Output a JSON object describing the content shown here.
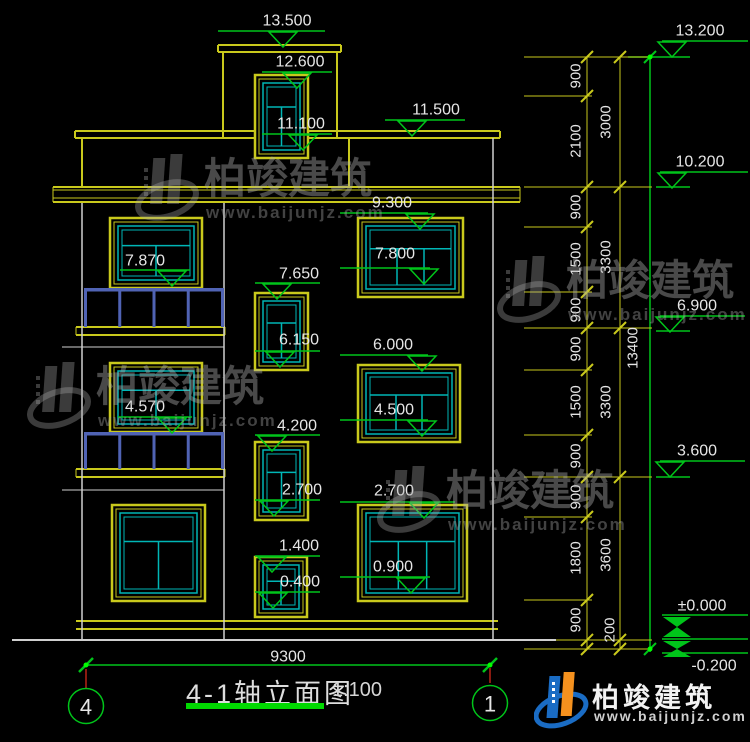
{
  "title": {
    "text": "4-1轴立面图",
    "scale": "1:100"
  },
  "brand": {
    "name": "柏竣建筑",
    "url": "www.baijunjz.com"
  },
  "axes": [
    {
      "label": "4",
      "cx": 86,
      "cy": 706
    },
    {
      "label": "1",
      "cx": 490,
      "cy": 703
    }
  ],
  "colors": {
    "yellow": "#c9c91c",
    "white": "#cfcfcf",
    "green": "#00c41a",
    "cyan": "#00b6b6",
    "blue": "#5063b4",
    "red": "#8a1a10",
    "text": "#e6e6e6",
    "dot": "#00ff00"
  },
  "drawing": {
    "lines": [
      {
        "p": [
          218,
          45,
          341,
          45
        ],
        "c": "yellow",
        "w": 2
      },
      {
        "p": [
          218,
          52,
          341,
          52
        ],
        "c": "yellow",
        "w": 2
      },
      {
        "p": [
          218,
          45,
          218,
          52
        ],
        "c": "yellow",
        "w": 2
      },
      {
        "p": [
          341,
          45,
          341,
          52
        ],
        "c": "yellow",
        "w": 2
      },
      {
        "p": [
          223,
          52,
          223,
          138
        ],
        "c": "yellow",
        "w": 2
      },
      {
        "p": [
          337,
          52,
          337,
          138
        ],
        "c": "yellow",
        "w": 2
      },
      {
        "p": [
          75,
          131,
          500,
          131
        ],
        "c": "yellow",
        "w": 2
      },
      {
        "p": [
          75,
          138,
          500,
          138
        ],
        "c": "yellow",
        "w": 2
      },
      {
        "p": [
          75,
          131,
          75,
          138
        ],
        "c": "yellow",
        "w": 2
      },
      {
        "p": [
          500,
          131,
          500,
          138
        ],
        "c": "yellow",
        "w": 2
      },
      {
        "p": [
          82,
          138,
          82,
          187
        ],
        "c": "yellow",
        "w": 2
      },
      {
        "p": [
          349,
          138,
          349,
          187
        ],
        "c": "yellow",
        "w": 2
      },
      {
        "p": [
          53,
          187,
          520,
          187
        ],
        "c": "yellow",
        "w": 2
      },
      {
        "p": [
          53,
          190,
          520,
          190
        ],
        "c": "yellow",
        "w": 1
      },
      {
        "p": [
          53,
          198,
          520,
          198
        ],
        "c": "yellow",
        "w": 1
      },
      {
        "p": [
          53,
          202,
          520,
          202
        ],
        "c": "yellow",
        "w": 2
      },
      {
        "p": [
          53,
          187,
          53,
          202
        ],
        "c": "yellow",
        "w": 1
      },
      {
        "p": [
          520,
          187,
          520,
          202
        ],
        "c": "yellow",
        "w": 1
      },
      {
        "p": [
          76,
          621,
          498,
          621
        ],
        "c": "yellow",
        "w": 2
      },
      {
        "p": [
          76,
          629,
          498,
          629
        ],
        "c": "yellow",
        "w": 2
      },
      {
        "p": [
          76,
          327,
          225,
          327
        ],
        "c": "yellow",
        "w": 2
      },
      {
        "p": [
          76,
          335,
          225,
          335
        ],
        "c": "yellow",
        "w": 2
      },
      {
        "p": [
          76,
          327,
          76,
          335
        ],
        "c": "yellow",
        "w": 1
      },
      {
        "p": [
          225,
          327,
          225,
          335
        ],
        "c": "yellow",
        "w": 1
      },
      {
        "p": [
          76,
          469,
          225,
          469
        ],
        "c": "yellow",
        "w": 2
      },
      {
        "p": [
          76,
          477,
          225,
          477
        ],
        "c": "yellow",
        "w": 2
      },
      {
        "p": [
          76,
          469,
          76,
          477
        ],
        "c": "yellow",
        "w": 1
      },
      {
        "p": [
          225,
          469,
          225,
          477
        ],
        "c": "yellow",
        "w": 1
      },
      {
        "p": [
          493,
          138,
          493,
          640
        ],
        "c": "white",
        "w": 1.5
      },
      {
        "p": [
          82,
          203,
          82,
          640
        ],
        "c": "white",
        "w": 1.5
      },
      {
        "p": [
          224,
          203,
          224,
          640
        ],
        "c": "white",
        "w": 1.5
      },
      {
        "p": [
          62,
          347,
          224,
          347
        ],
        "c": "white",
        "w": 1
      },
      {
        "p": [
          62,
          490,
          224,
          490
        ],
        "c": "white",
        "w": 1
      },
      {
        "p": [
          12,
          640,
          556,
          640
        ],
        "c": "white",
        "w": 2
      },
      {
        "p": [
          86,
          665,
          490,
          665
        ],
        "c": "green",
        "w": 1.5
      },
      {
        "p": [
          650,
          57,
          650,
          652
        ],
        "c": "green",
        "w": 1.5
      },
      {
        "p": [
          628,
          57,
          690,
          57
        ],
        "c": "green",
        "w": 1.5
      },
      {
        "p": [
          656,
          187,
          690,
          187
        ],
        "c": "green",
        "w": 1.5
      },
      {
        "p": [
          656,
          331,
          690,
          331
        ],
        "c": "green",
        "w": 1.5
      },
      {
        "p": [
          656,
          477,
          690,
          477
        ],
        "c": "green",
        "w": 1.5
      },
      {
        "p": [
          662,
          615,
          748,
          615
        ],
        "c": "green",
        "w": 1.5
      },
      {
        "p": [
          662,
          639,
          748,
          639
        ],
        "c": "green",
        "w": 1.5
      },
      {
        "p": [
          662,
          653,
          748,
          653
        ],
        "c": "green",
        "w": 1.5
      },
      {
        "p": [
          587,
          57,
          587,
          649
        ],
        "c": "yellow",
        "w": 1
      },
      {
        "p": [
          620,
          57,
          620,
          649
        ],
        "c": "yellow",
        "w": 1
      },
      {
        "p": [
          524,
          96,
          592,
          96
        ],
        "c": "yellow",
        "w": 1
      },
      {
        "p": [
          524,
          227,
          592,
          227
        ],
        "c": "yellow",
        "w": 1
      },
      {
        "p": [
          524,
          292,
          592,
          292
        ],
        "c": "yellow",
        "w": 1
      },
      {
        "p": [
          524,
          370,
          592,
          370
        ],
        "c": "yellow",
        "w": 1
      },
      {
        "p": [
          524,
          435,
          592,
          435
        ],
        "c": "yellow",
        "w": 1
      },
      {
        "p": [
          524,
          517,
          592,
          517
        ],
        "c": "yellow",
        "w": 1
      },
      {
        "p": [
          524,
          600,
          592,
          600
        ],
        "c": "yellow",
        "w": 1
      },
      {
        "p": [
          524,
          57,
          652,
          57
        ],
        "c": "yellow",
        "w": 1
      },
      {
        "p": [
          524,
          187,
          652,
          187
        ],
        "c": "yellow",
        "w": 1
      },
      {
        "p": [
          524,
          328,
          652,
          328
        ],
        "c": "yellow",
        "w": 1
      },
      {
        "p": [
          524,
          477,
          652,
          477
        ],
        "c": "yellow",
        "w": 1
      },
      {
        "p": [
          556,
          640,
          652,
          640
        ],
        "c": "yellow",
        "w": 1
      },
      {
        "p": [
          524,
          649,
          652,
          649
        ],
        "c": "yellow",
        "w": 1
      },
      {
        "p": [
          86,
          669,
          86,
          688
        ],
        "c": "red",
        "w": 2
      },
      {
        "p": [
          490,
          668,
          490,
          683
        ],
        "c": "red",
        "w": 2
      }
    ],
    "windows": [
      {
        "x": 255,
        "y": 75,
        "w": 53,
        "h": 83,
        "style": "T",
        "name": "tower-window"
      },
      {
        "x": 110,
        "y": 218,
        "w": 92,
        "h": 70,
        "style": "T",
        "name": "balcony-window-7870"
      },
      {
        "x": 110,
        "y": 363,
        "w": 92,
        "h": 69,
        "style": "T",
        "name": "balcony-window-4570"
      },
      {
        "x": 112,
        "y": 505,
        "w": 93,
        "h": 96,
        "style": "T",
        "name": "left-window-ground"
      },
      {
        "x": 255,
        "y": 293,
        "w": 53,
        "h": 77,
        "style": "T",
        "name": "mid-window-7650"
      },
      {
        "x": 255,
        "y": 442,
        "w": 53,
        "h": 78,
        "style": "T",
        "name": "mid-window-4200"
      },
      {
        "x": 255,
        "y": 557,
        "w": 52,
        "h": 60,
        "style": "T",
        "name": "mid-window-1400"
      },
      {
        "x": 358,
        "y": 218,
        "w": 105,
        "h": 79,
        "style": "P3",
        "name": "right-window-7800"
      },
      {
        "x": 358,
        "y": 365,
        "w": 102,
        "h": 77,
        "style": "P3",
        "name": "right-window-4500"
      },
      {
        "x": 358,
        "y": 505,
        "w": 109,
        "h": 96,
        "style": "P3",
        "name": "right-window-0900"
      }
    ],
    "balconies": [
      {
        "x1": 84,
        "x2": 224,
        "railY": 288,
        "slabY": 327
      },
      {
        "x1": 84,
        "x2": 224,
        "railY": 432,
        "slabY": 469
      }
    ],
    "markers": [
      [
        "13.500",
        287,
        21,
        218,
        325,
        31,
        283
      ],
      [
        "12.600",
        300,
        62,
        262,
        332,
        72,
        297
      ],
      [
        "11.100",
        301,
        124,
        262,
        332,
        134,
        303
      ],
      [
        "11.500",
        436,
        110,
        385,
        465,
        120,
        412
      ],
      [
        "9.300",
        392,
        203,
        340,
        428,
        213,
        420
      ],
      [
        "7.870",
        145,
        261,
        120,
        190,
        270,
        172
      ],
      [
        "7.800",
        395,
        254,
        340,
        430,
        268,
        424
      ],
      [
        "7.650",
        299,
        274,
        255,
        320,
        283,
        277
      ],
      [
        "6.150",
        299,
        340,
        255,
        320,
        351,
        280
      ],
      [
        "6.000",
        393,
        345,
        340,
        428,
        355,
        422
      ],
      [
        "4.570",
        145,
        407,
        118,
        192,
        417,
        172
      ],
      [
        "4.500",
        394,
        410,
        340,
        428,
        420,
        422
      ],
      [
        "4.200",
        297,
        426,
        255,
        320,
        435,
        272
      ],
      [
        "2.700",
        302,
        490,
        255,
        320,
        500,
        274
      ],
      [
        "2.700",
        394,
        491,
        340,
        455,
        502,
        424
      ],
      [
        "1.400",
        299,
        546,
        255,
        320,
        556,
        272
      ],
      [
        "0.900",
        393,
        567,
        340,
        430,
        577,
        411
      ],
      [
        "0.400",
        300,
        582,
        255,
        320,
        592,
        273
      ],
      [
        "13.200",
        700,
        31,
        662,
        748,
        41,
        672
      ],
      [
        "10.200",
        700,
        162,
        660,
        748,
        172,
        672
      ],
      [
        "6.900",
        697,
        306,
        660,
        745,
        316,
        670
      ],
      [
        "3.600",
        697,
        451,
        660,
        745,
        461,
        670
      ]
    ],
    "zero_markers": {
      "bowties": [
        {
          "cx": 677,
          "top": 617,
          "bot": 637
        },
        {
          "cx": 677,
          "top": 641,
          "bot": 657
        }
      ],
      "labels": [
        {
          "t": "±0.000",
          "x": 702,
          "y": 606
        },
        {
          "t": "-0.200",
          "x": 714,
          "y": 666
        }
      ]
    },
    "ticks": {
      "chain1": {
        "x": 587,
        "ys": [
          57,
          96,
          187,
          227,
          292,
          328,
          370,
          435,
          477,
          517,
          600,
          640,
          649
        ]
      },
      "chain2": {
        "x": 620,
        "ys": [
          57,
          187,
          328,
          477,
          640,
          649
        ]
      },
      "overall": {
        "x": 650,
        "ys": [
          57,
          649
        ]
      }
    },
    "xmarks": [
      {
        "x": 86,
        "y": 665
      },
      {
        "x": 490,
        "y": 665
      }
    ],
    "dots": [
      {
        "x": 650,
        "y": 57
      },
      {
        "x": 650,
        "y": 649
      },
      {
        "x": 86,
        "y": 665
      },
      {
        "x": 490,
        "y": 665
      }
    ],
    "dim_labels_rot": [
      {
        "t": "900",
        "x": 576,
        "y": 76
      },
      {
        "t": "2100",
        "x": 576,
        "y": 141
      },
      {
        "t": "900",
        "x": 576,
        "y": 207
      },
      {
        "t": "1500",
        "x": 576,
        "y": 259
      },
      {
        "t": "900",
        "x": 576,
        "y": 310
      },
      {
        "t": "900",
        "x": 576,
        "y": 349
      },
      {
        "t": "1500",
        "x": 576,
        "y": 402
      },
      {
        "t": "900",
        "x": 576,
        "y": 456
      },
      {
        "t": "900",
        "x": 576,
        "y": 497
      },
      {
        "t": "1800",
        "x": 576,
        "y": 558
      },
      {
        "t": "900",
        "x": 576,
        "y": 620
      },
      {
        "t": "200",
        "x": 610,
        "y": 630
      },
      {
        "t": "3000",
        "x": 606,
        "y": 122
      },
      {
        "t": "3300",
        "x": 606,
        "y": 257
      },
      {
        "t": "3300",
        "x": 606,
        "y": 402
      },
      {
        "t": "3600",
        "x": 606,
        "y": 555
      },
      {
        "t": "13400",
        "x": 633,
        "y": 348
      }
    ],
    "h_labels": [
      {
        "t": "9300",
        "x": 288,
        "y": 657,
        "s": 16
      }
    ]
  },
  "watermarks": [
    {
      "x": 134,
      "y": 148
    },
    {
      "x": 26,
      "y": 356
    },
    {
      "x": 496,
      "y": 250
    },
    {
      "x": 376,
      "y": 460
    }
  ]
}
